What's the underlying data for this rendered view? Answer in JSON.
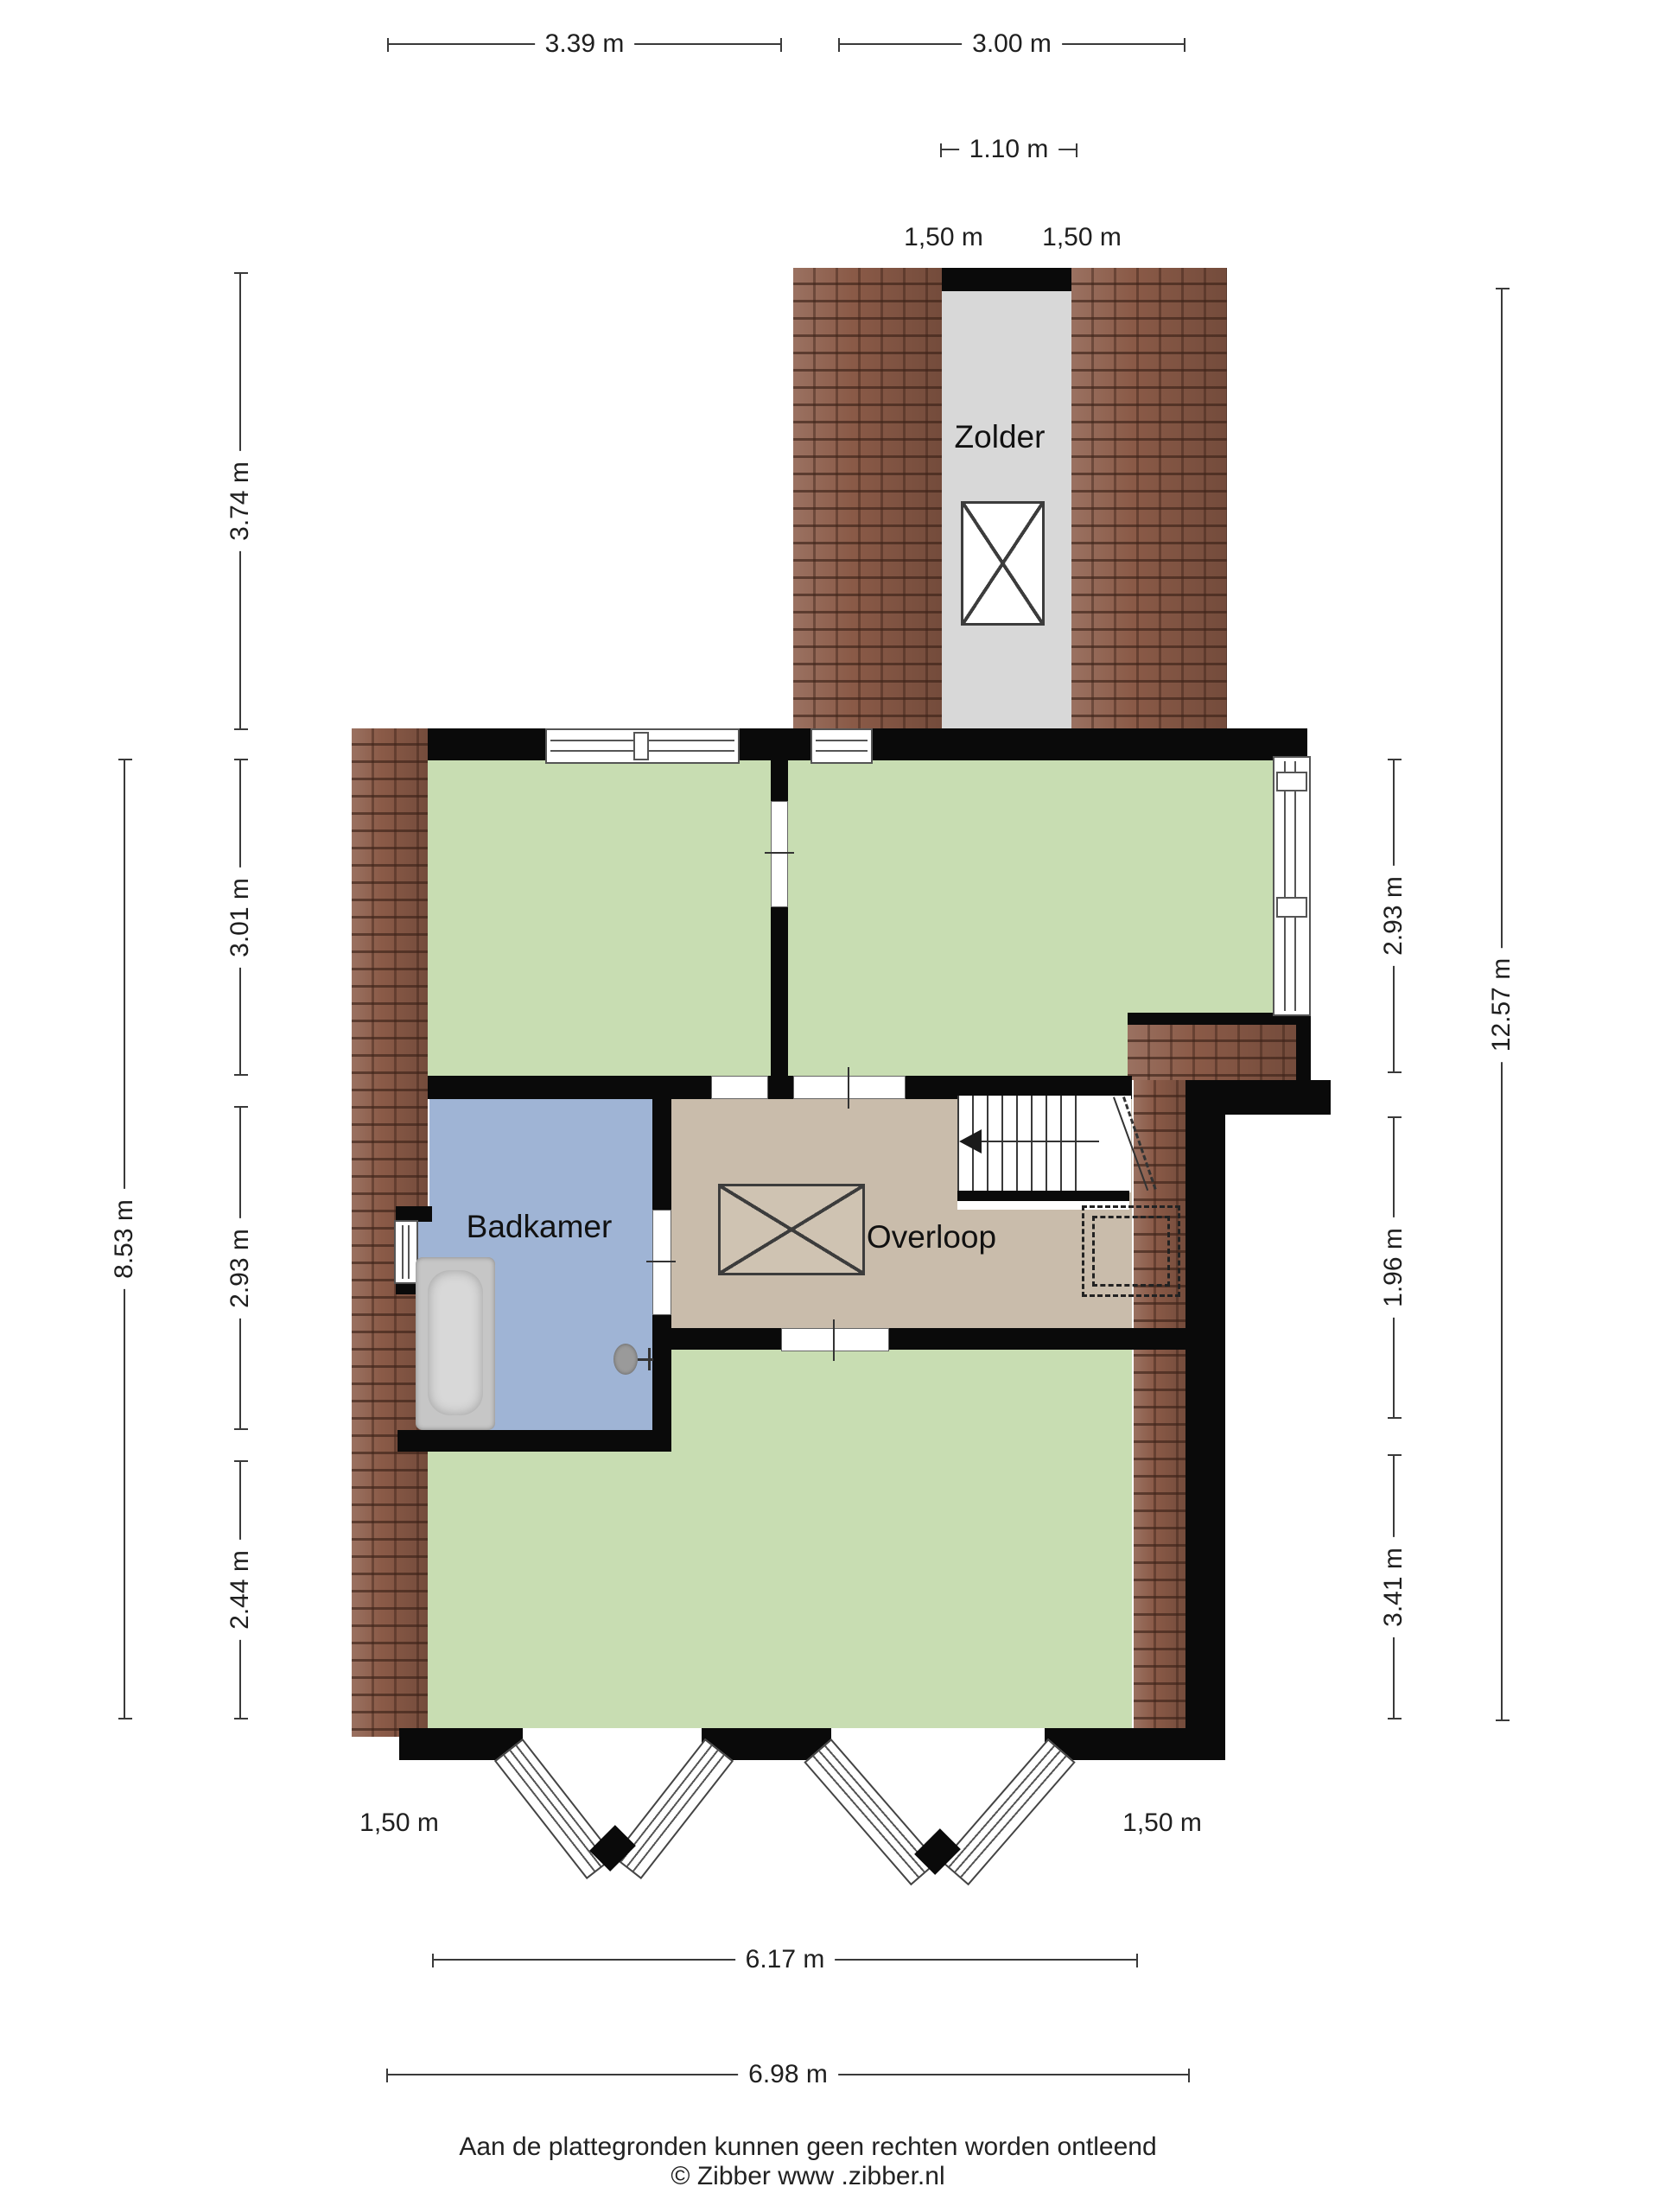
{
  "rooms": {
    "zolder": "Zolder",
    "badkamer": "Badkamer",
    "overloop": "Overloop"
  },
  "dimensions": {
    "top": [
      {
        "label": "3.39 m"
      },
      {
        "label": "3.00 m"
      },
      {
        "label": "1.10 m"
      }
    ],
    "zolder_widths": [
      {
        "label": "1,50 m"
      },
      {
        "label": "1,50 m"
      }
    ],
    "left_outer": {
      "label": "8.53 m"
    },
    "left_inner": [
      {
        "label": "3.74 m"
      },
      {
        "label": "3.01 m"
      },
      {
        "label": "2.93 m"
      },
      {
        "label": "2.44 m"
      }
    ],
    "right_inner": [
      {
        "label": "2.93 m"
      },
      {
        "label": "1.96 m"
      },
      {
        "label": "3.41 m"
      }
    ],
    "right_outer": {
      "label": "12.57 m"
    },
    "bottom_widths": [
      {
        "label": "1,50 m"
      },
      {
        "label": "1,50 m"
      }
    ],
    "bottom": [
      {
        "label": "6.17 m"
      },
      {
        "label": "6.98 m"
      }
    ]
  },
  "footer": {
    "line1": "Aan de plattegronden kunnen geen rechten worden ontleend",
    "line2": "© Zibber www .zibber.nl"
  },
  "colors": {
    "room_green": "#c8ddb2",
    "room_blue": "#9fb4d5",
    "room_tan": "#c9bcab",
    "attic_gray": "#d8d8d8",
    "roof_brick": "#8a5a47",
    "wall_black": "#0a0a0a"
  }
}
